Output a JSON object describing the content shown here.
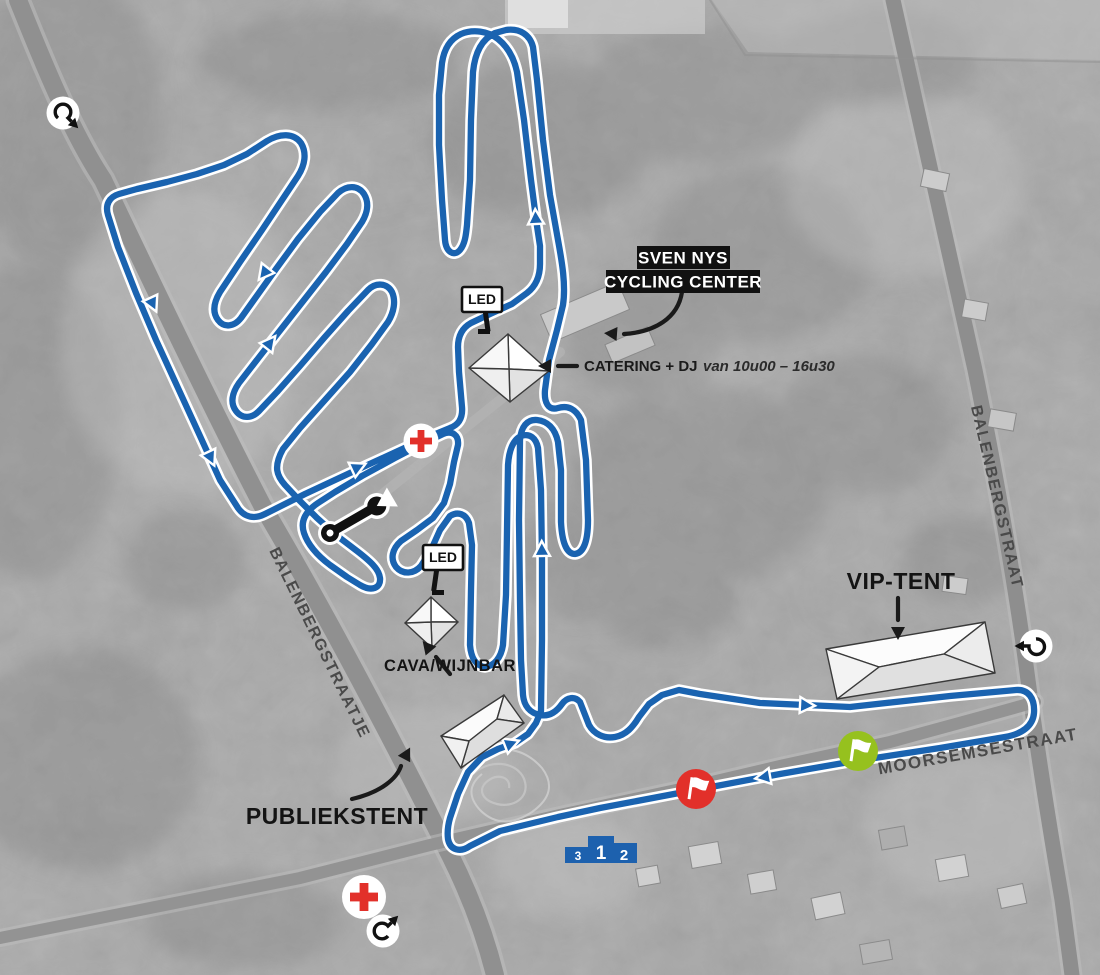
{
  "labels": {
    "venue": {
      "line1": "SVEN NYS",
      "line2": "CYCLING CENTER"
    },
    "catering": {
      "bold": "CATERING + DJ",
      "italic": "van 10u00 – 16u30"
    },
    "vip_tent": "VIP-TENT",
    "publiekstent": "PUBLIEKSTENT",
    "cava": "CAVA/WIJNBAR",
    "led1": "LED",
    "led2": "LED"
  },
  "streets": {
    "west": "BALENBERGSTRAATJE",
    "east": "BALENBERGSTRAAT",
    "south": "MOORSEMSESTRAAT"
  },
  "podium": {
    "first": "1",
    "second": "2",
    "third": "3"
  },
  "icons": {
    "entry_top_left": "circular-arrow-icon",
    "entry_right": "circular-arrow-icon",
    "entry_bottom": "circular-arrow-icon",
    "medical_center": "red-cross-icon",
    "medical_south": "red-cross-icon",
    "pit_zone": "wrench-icon",
    "start": "green-flag-icon",
    "finish": "red-flag-icon",
    "screen": "led-sign",
    "podium": "podium-icon",
    "tents": "tent-roof-shape"
  },
  "colors": {
    "course_blue": "#1a63b0",
    "podium_blue": "#1d61ae",
    "start_green": "#96c11e",
    "finish_red": "#e2302a",
    "medical_red": "#e2302a",
    "label_black": "#111111",
    "street_gray": "#4a4a4a",
    "terrain_gray": "#a7a7a7"
  }
}
